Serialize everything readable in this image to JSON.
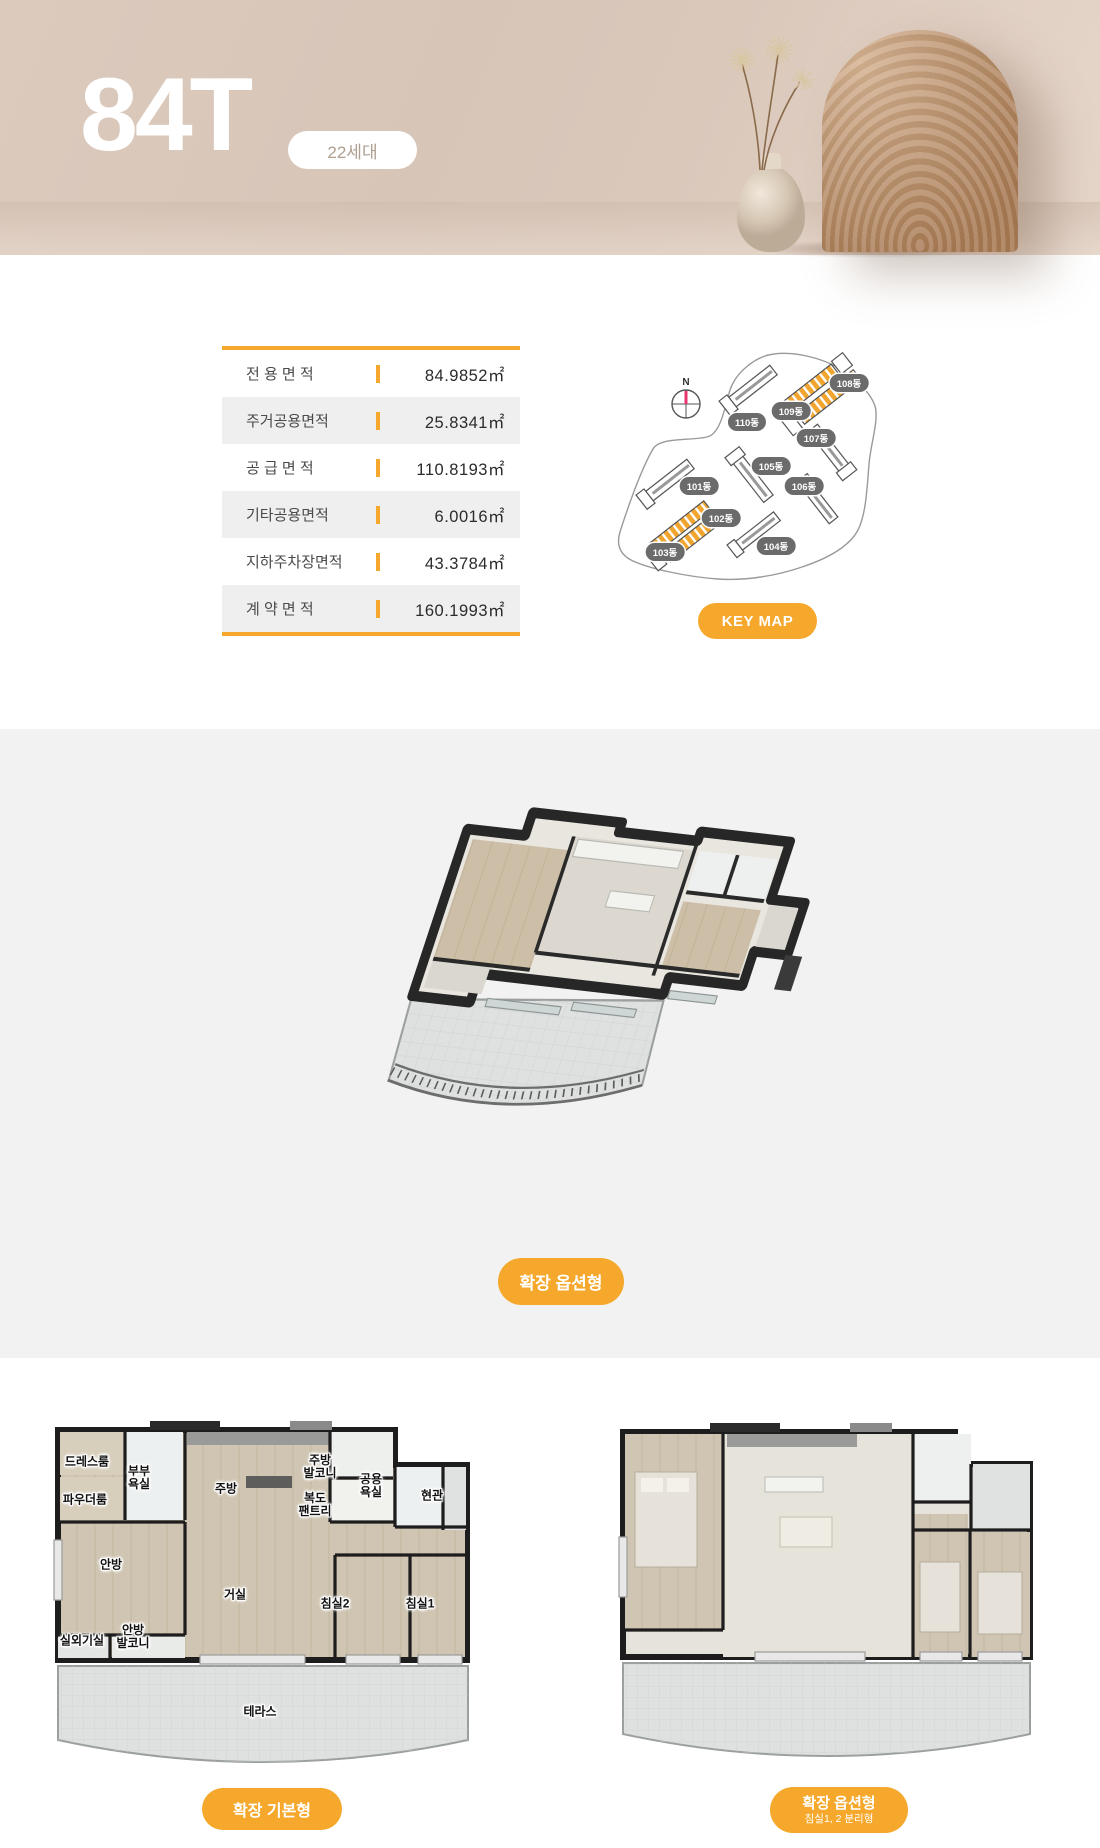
{
  "header": {
    "unit_type": "84T",
    "badge": "22세대"
  },
  "area_table": {
    "rows": [
      {
        "label": "전 용 면 적",
        "value": "84.9852㎡"
      },
      {
        "label": "주거공용면적",
        "value": "25.8341㎡"
      },
      {
        "label": "공 급 면 적",
        "value": "110.8193㎡"
      },
      {
        "label": "기타공용면적",
        "value": "6.0016㎡"
      },
      {
        "label": "지하주차장면적",
        "value": "43.3784㎡"
      },
      {
        "label": "계 약 면 적",
        "value": "160.1993㎡"
      }
    ]
  },
  "key_map": {
    "compass": "N",
    "button": "KEY MAP",
    "labels": [
      "108동",
      "109동",
      "110동",
      "107동",
      "105동",
      "106동",
      "101동",
      "102동",
      "104동",
      "103동"
    ],
    "highlighted": [
      "108동",
      "103동"
    ]
  },
  "floor_plan_3d": {
    "caption_button": "확장 옵션형"
  },
  "floor_plan_basic": {
    "caption_button": "확장 기본형",
    "rooms": {
      "dress": "드레스룸",
      "bath_master": "부부\n욕실",
      "powder": "파우더룸",
      "kitchen": "주방",
      "kitchen_balcony": "주방\n발코니",
      "pantry": "복도\n팬트리",
      "bath_common": "공용\n욕실",
      "entrance": "현관",
      "master": "안방",
      "living": "거실",
      "bed2": "침실2",
      "bed1": "침실1",
      "ac_room": "실외기실",
      "master_balcony": "안방\n발코니",
      "terrace": "테라스"
    }
  },
  "floor_plan_option": {
    "caption_button": "확장 옵션형",
    "caption_sub": "침실1, 2 분리형"
  },
  "colors": {
    "accent_orange": "#F5A82B",
    "header_beige": "#D9C8BC",
    "badge_text": "#AE9F90",
    "table_alt_row": "#EFEFEF",
    "section_gray": "#F2F2F2",
    "map_pill_gray": "#6B6B6B",
    "map_highlight_orange": "#F2A52E",
    "compass_needle_pink": "#E8366F"
  }
}
